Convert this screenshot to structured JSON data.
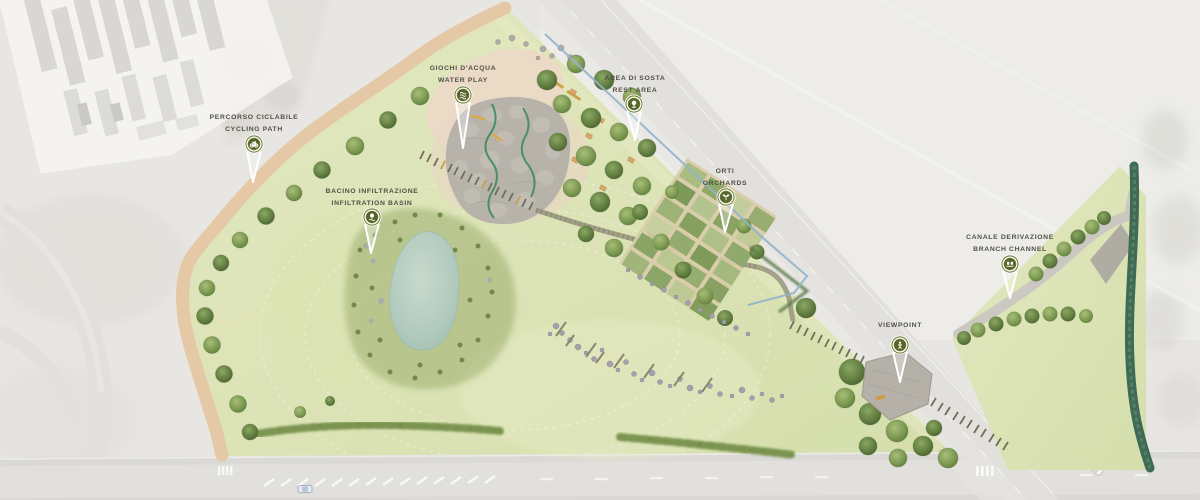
{
  "plan": {
    "markers": [
      {
        "id": "cycling-path",
        "label_it": "PERCORSO CICLABILE",
        "label_en": "CYCLING PATH",
        "icon": "bicycle-icon"
      },
      {
        "id": "water-play",
        "label_it": "GIOCHI D'ACQUA",
        "label_en": "WATER PLAY",
        "icon": "water-waves-icon"
      },
      {
        "id": "rest-area",
        "label_it": "AREA DI SOSTA",
        "label_en": "REST AREA",
        "icon": "tree-icon"
      },
      {
        "id": "orchards",
        "label_it": "ORTI",
        "label_en": "ORCHARDS",
        "icon": "sprout-icon"
      },
      {
        "id": "infiltration-basin",
        "label_it": "BACINO INFILTRAZIONE",
        "label_en": "INFILTRATION BASIN",
        "icon": "basin-tree-icon"
      },
      {
        "id": "branch-channel",
        "label_it": "CANALE DERIVAZIONE",
        "label_en": "BRANCH CHANNEL",
        "icon": "sluice-gate-icon"
      },
      {
        "id": "viewpoint",
        "label_it": "VIEWPOINT",
        "label_en": "",
        "icon": "person-icon"
      }
    ],
    "colors": {
      "pin_ring": "#6e7b31",
      "pin_core": "#57662a",
      "label_text": "#505046",
      "park_green": "#dce3b4",
      "pond_water": "#b5cdc2",
      "channel_green": "#3f6b54",
      "irrigation_blue": "#8fb3cc",
      "path_tan": "#e5c8a5",
      "road_gray": "#e2e0dc",
      "stone_gray": "#b7b3ab"
    }
  }
}
